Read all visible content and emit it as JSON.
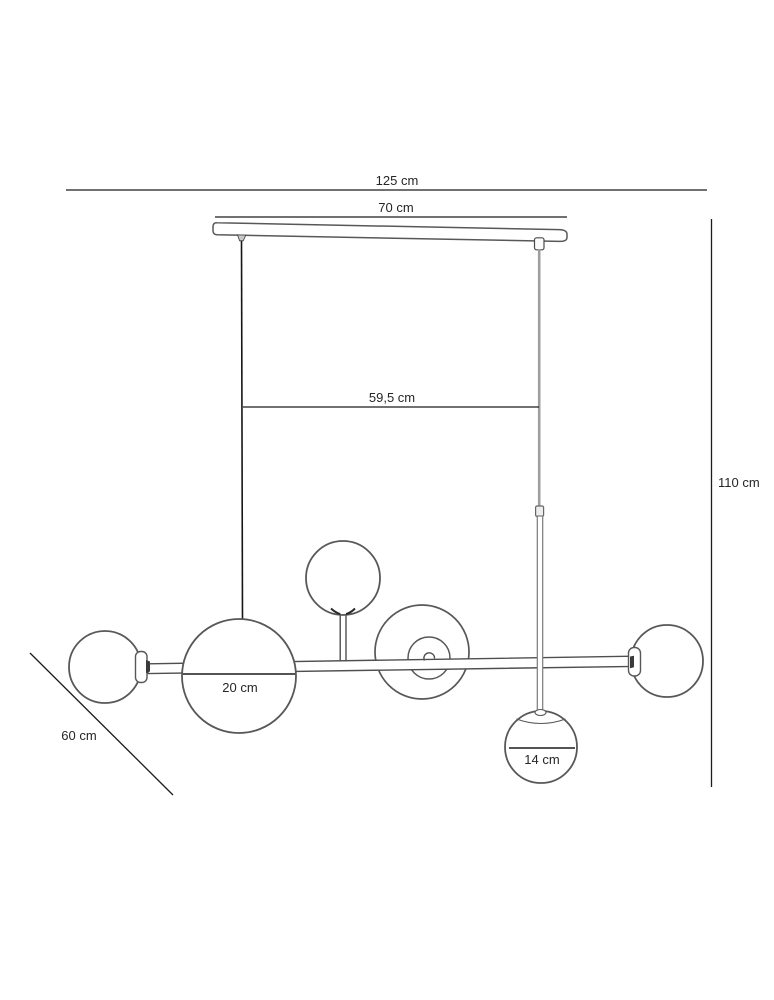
{
  "diagram": {
    "background": "#ffffff",
    "ink_color": "#1c1c1c",
    "fixture_line_color": "#585858",
    "left_cable_color": "#161616",
    "right_cable_color": "#9e9e9e",
    "dimensions": {
      "overall_width": "125 cm",
      "canopy_width": "70 cm",
      "cord_spacing": "59,5 cm",
      "overall_height": "110 cm",
      "depth": "60 cm",
      "large_globe_diameter": "20 cm",
      "small_globe_diameter": "14 cm"
    }
  }
}
